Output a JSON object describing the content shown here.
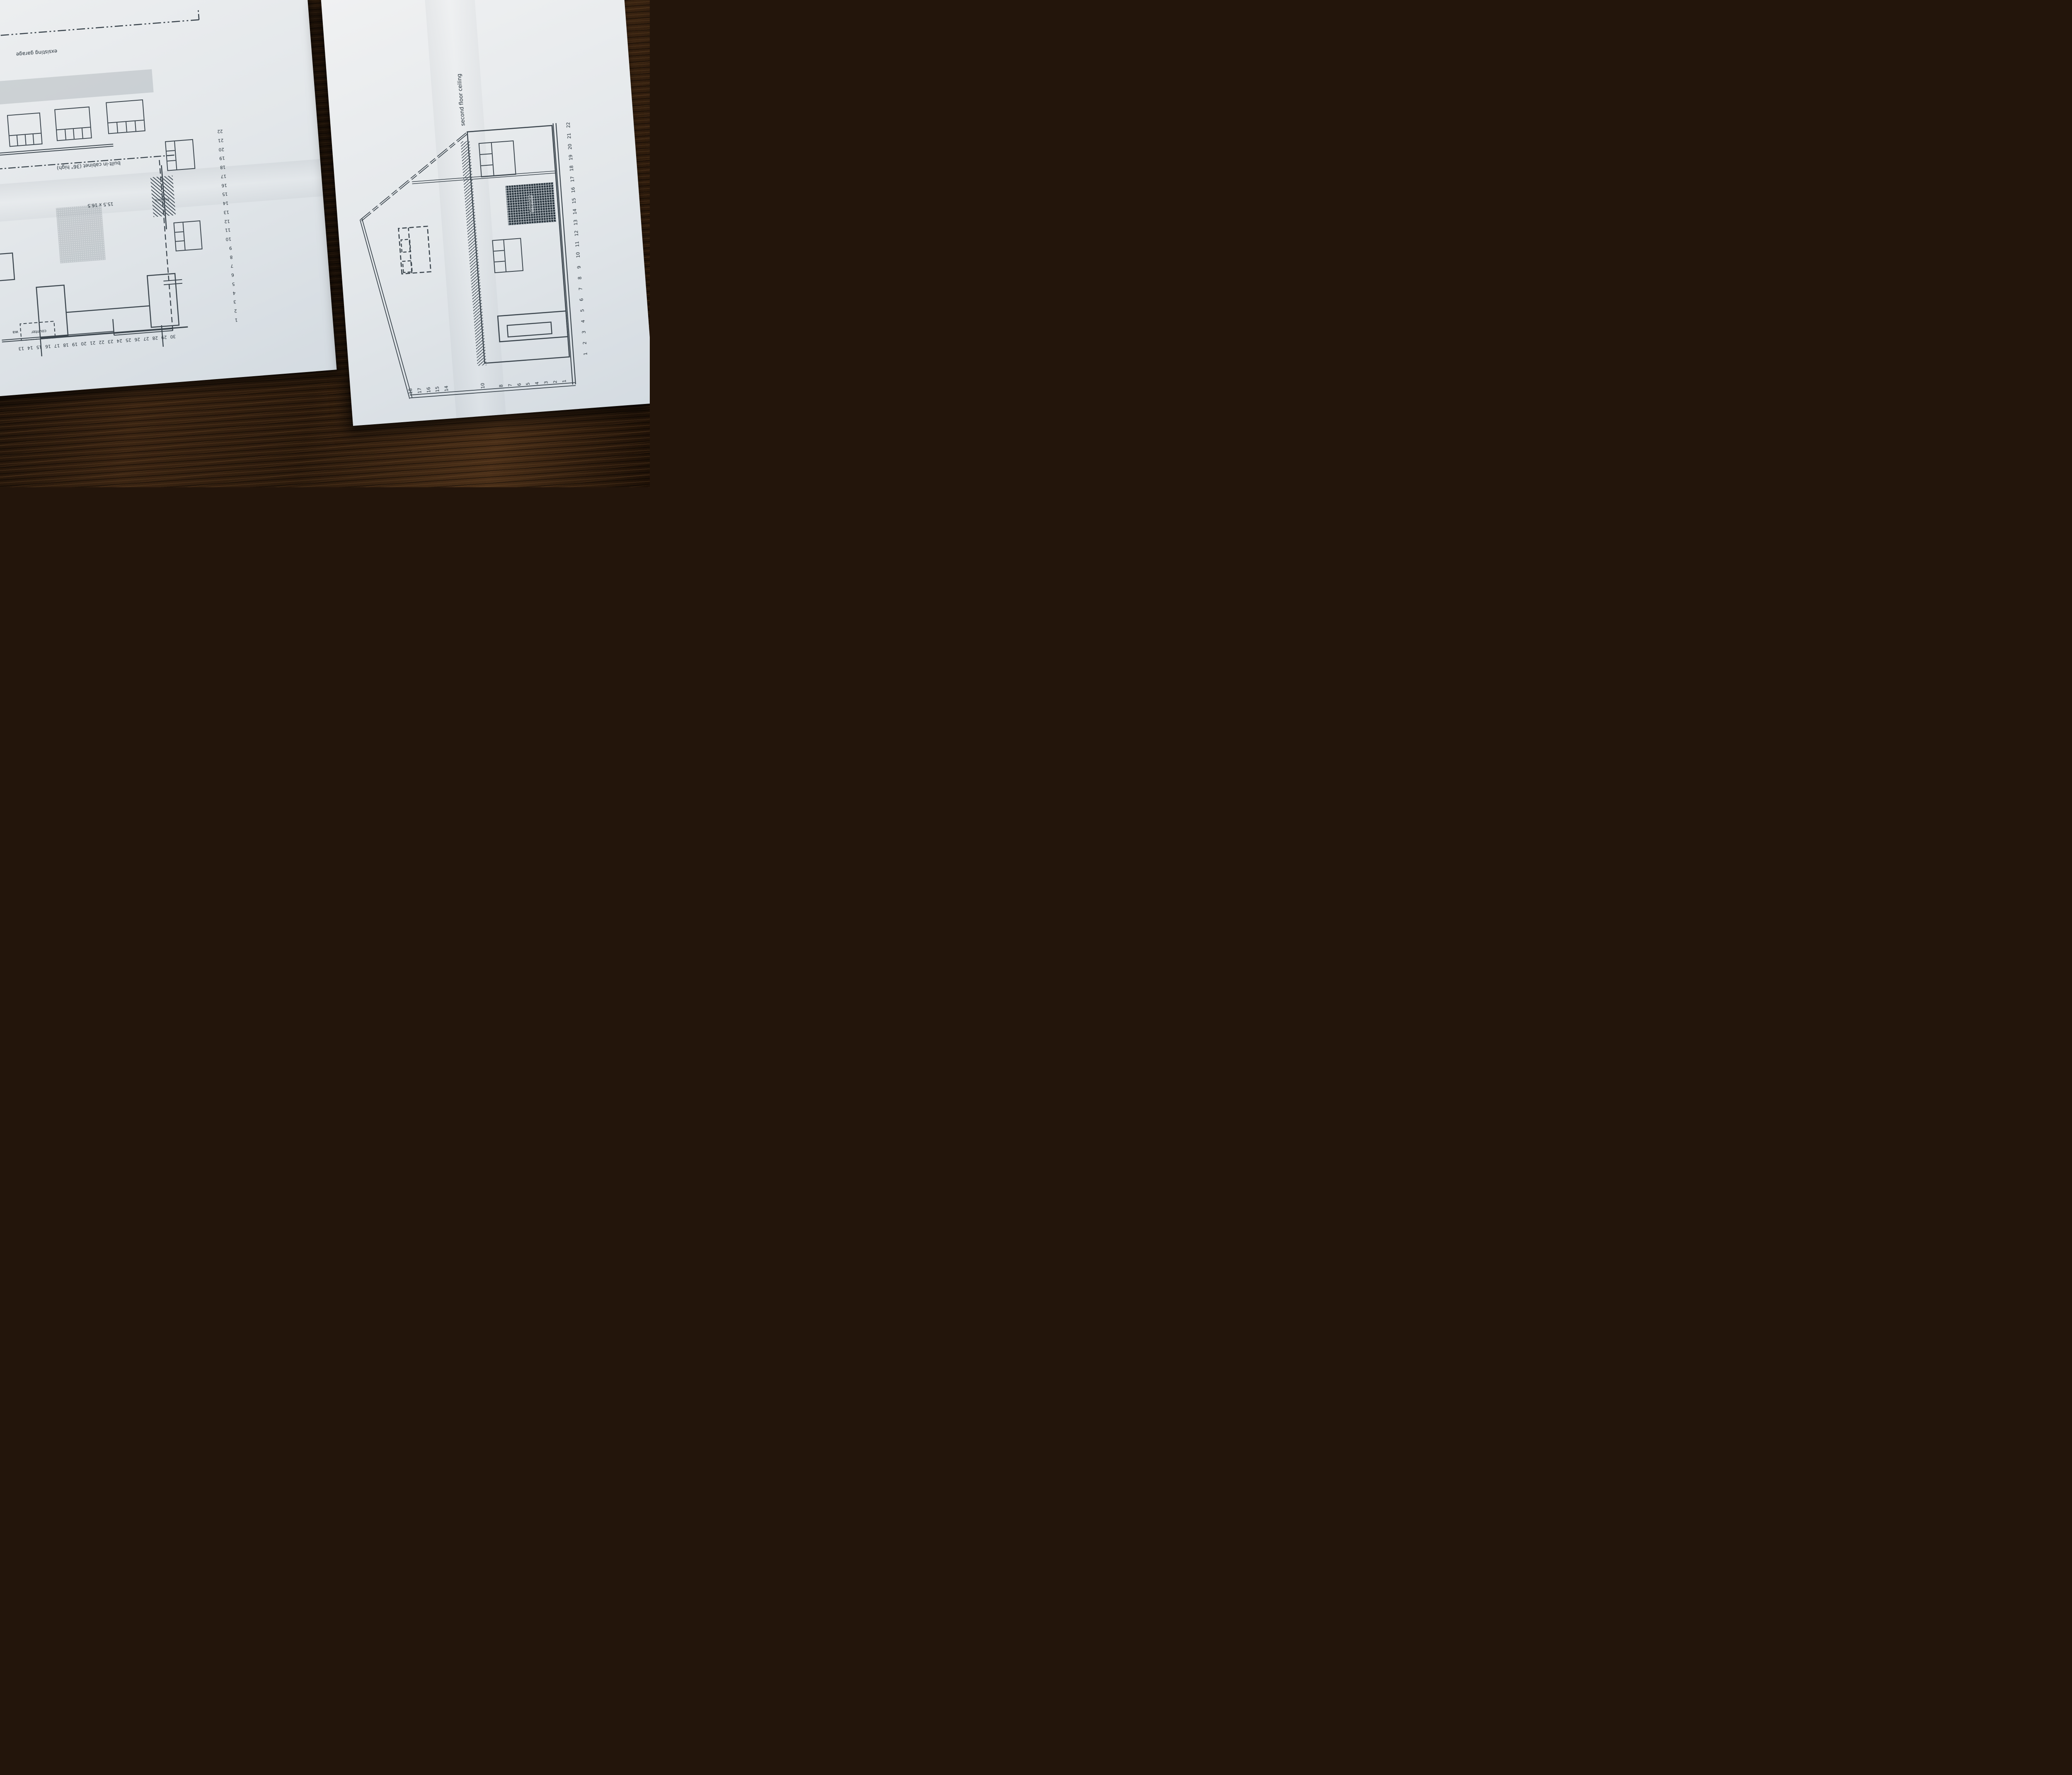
{
  "left_plan": {
    "labels": {
      "garage": "exsisting garage",
      "cabinet": "built-in cabinet (36\" high)",
      "fireplace": "fireplace",
      "room_dims": "15.5 x 16.5",
      "counter": "counter",
      "wall_fragment": "wa"
    },
    "top_scale": [
      "30",
      "29",
      "28",
      "27",
      "26",
      "25",
      "24",
      "23",
      "22",
      "21",
      "20",
      "19",
      "18",
      "17",
      "16",
      "15",
      "14",
      "13"
    ],
    "side_scale": [
      "1",
      "2",
      "3",
      "4",
      "5",
      "6",
      "7",
      "8",
      "9",
      "10",
      "11",
      "12",
      "13",
      "14",
      "15",
      "16",
      "17",
      "18",
      "19",
      "20",
      "21",
      "22"
    ]
  },
  "right_elevation": {
    "labels": {
      "ceiling": "second floor ceiling",
      "fireplace": "fireplace"
    },
    "bottom_scale": [
      "1",
      "2",
      "3",
      "4",
      "5",
      "6",
      "7",
      "8",
      "9",
      "10",
      "11",
      "12",
      "13",
      "14",
      "15",
      "16",
      "17",
      "18",
      "19",
      "20",
      "21",
      "22"
    ],
    "left_scale": [
      "18",
      "17",
      "16",
      "15",
      "14",
      "10",
      "8",
      "7",
      "6",
      "5",
      "4",
      "3",
      "2",
      "1"
    ]
  },
  "colors": {
    "ink": "#3c464e",
    "paper": "#e7eaec",
    "wood_dark": "#1d1006",
    "wood_mid": "#3a2412",
    "wood_light": "#6e4a28"
  }
}
